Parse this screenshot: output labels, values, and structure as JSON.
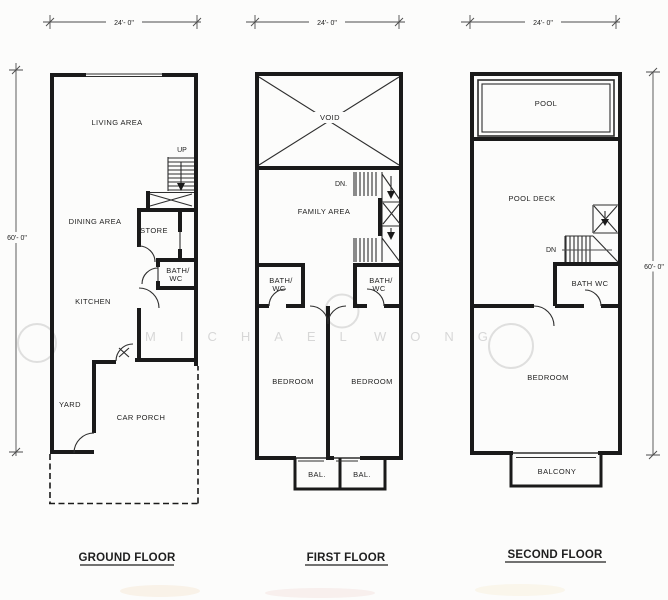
{
  "watermark": {
    "part1": "MICHAEL",
    "part2": "WONG"
  },
  "ground": {
    "title": "GROUND FLOOR",
    "dim_width": "24'- 0\"",
    "dim_height": "60'- 0\"",
    "living": "LIVING AREA",
    "up": "UP",
    "dining": "DINING AREA",
    "store": "STORE",
    "bath_line1": "BATH/",
    "bath_line2": "WC",
    "kitchen": "KITCHEN",
    "yard": "YARD",
    "car_porch": "CAR PORCH"
  },
  "first": {
    "title": "FIRST FLOOR",
    "dim_width": "24'- 0\"",
    "void": "VOID",
    "dn": "DN.",
    "family": "FAMILY AREA",
    "bath_left_line1": "BATH/",
    "bath_left_line2": "WC",
    "bath_right_line1": "BATH/",
    "bath_right_line2": "WC",
    "bedroom_left": "BEDROOM",
    "bedroom_right": "BEDROOM",
    "bal_left": "BAL.",
    "bal_right": "BAL."
  },
  "second": {
    "title": "SECOND FLOOR",
    "dim_width": "24'- 0\"",
    "dim_height": "60'- 0\"",
    "pool": "POOL",
    "pool_deck": "POOL DECK",
    "dn": "DN",
    "bath": "BATH WC",
    "bedroom": "BEDROOM",
    "balcony": "BALCONY"
  },
  "colors": {
    "wall": "#1a1a1a",
    "thin": "#2e2e2e",
    "dim": "#4d4d4d",
    "text": "#1f1f1f",
    "watermark": "#d7d7d7",
    "background": "#fcfcfb"
  }
}
